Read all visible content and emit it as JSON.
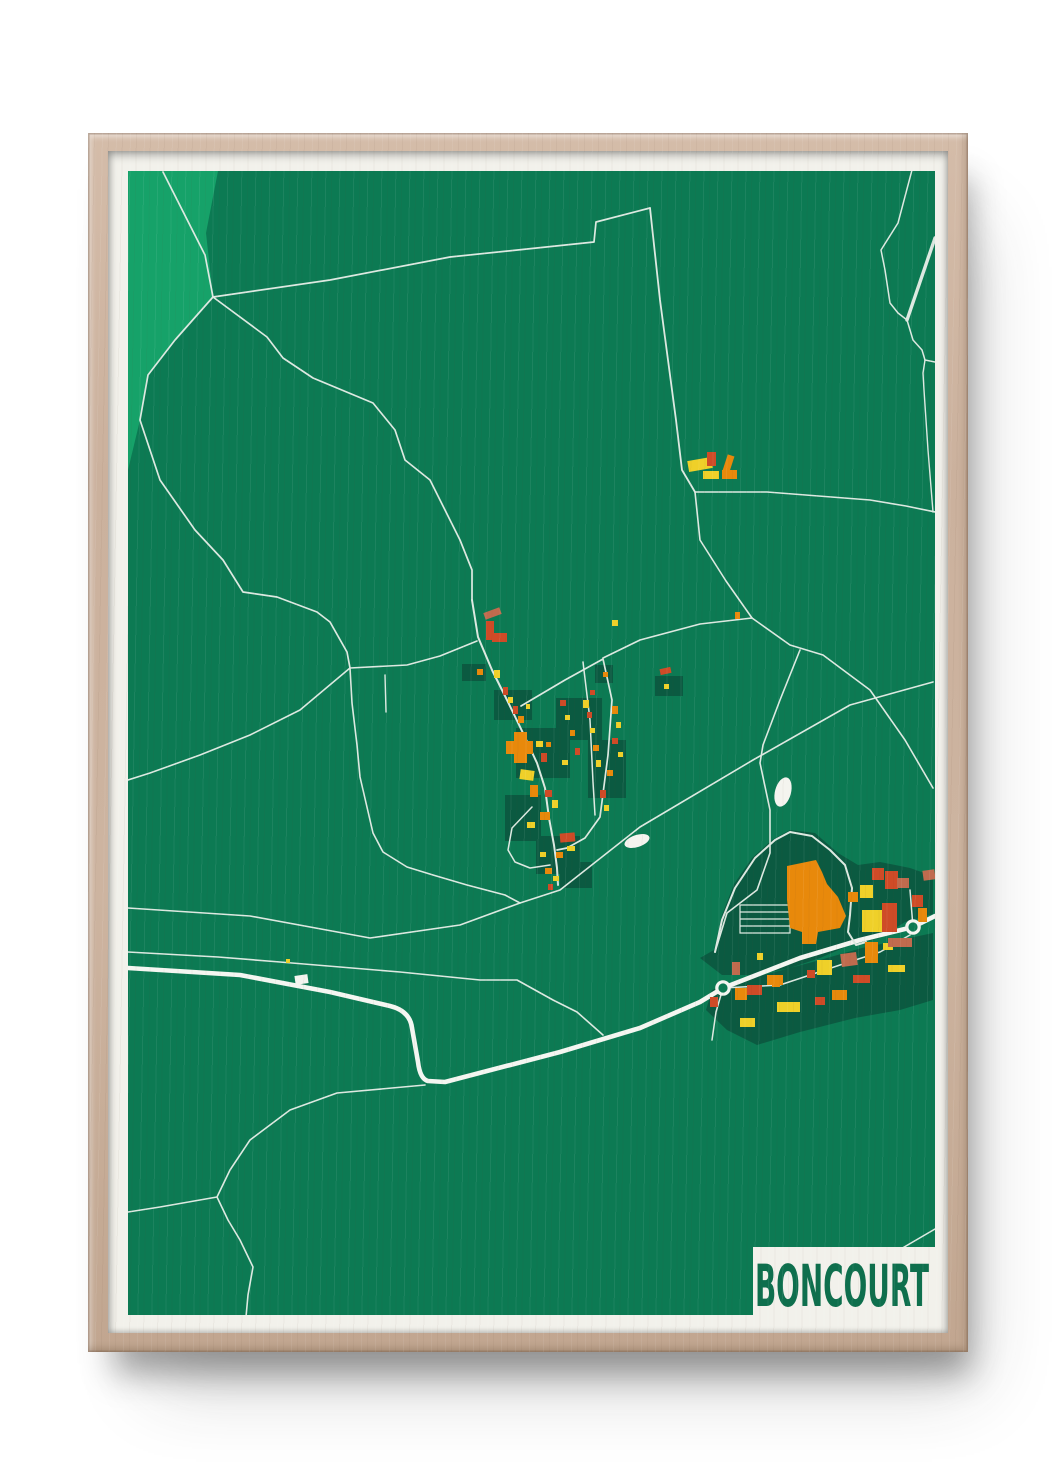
{
  "poster": {
    "title": "BONCOURT",
    "title_color": "#0e6f4d"
  },
  "theme": {
    "page_bg": "#ffffff",
    "wood": "#cbb19d",
    "paper": "#f2f1eb"
  },
  "map": {
    "width": 807,
    "height": 1144,
    "colors": {
      "base": "#0c7a53",
      "forest": "#16a269",
      "plot": "#0b5a41",
      "road": "#dde9e1",
      "road_major": "#f4f6f1",
      "white": "#f4f4ef",
      "orange": "#e8890b",
      "red": "#cf4b27",
      "salmon": "#c06b4e",
      "yellow": "#efd029"
    },
    "forest_polygon": "0,0 90,0 78,62 85,126 47,169 20,204 12,249 0,299",
    "zones": [
      "572,787 586,779 594,744 606,713 624,687 644,669 662,659 687,662 710,682 730,694 752,691 782,697 805,705 805,743 777,751 752,767 722,774 692,787 662,797 627,804 594,804",
      "578,839 584,819 607,811 647,801 692,789 734,777 772,769 805,762 805,829 772,839 727,847 672,861 629,874 599,859"
    ],
    "plots": [
      [
        334,
        493,
        24,
        17
      ],
      [
        467,
        494,
        18,
        18
      ],
      [
        527,
        505,
        28,
        20
      ],
      [
        366,
        519,
        38,
        30
      ],
      [
        388,
        557,
        54,
        50
      ],
      [
        428,
        527,
        46,
        42
      ],
      [
        460,
        569,
        38,
        58
      ],
      [
        377,
        624,
        36,
        46
      ],
      [
        408,
        665,
        44,
        38
      ],
      [
        432,
        691,
        32,
        26
      ]
    ],
    "roads": [
      {
        "name": "nw-boundary",
        "d": "M35 1 L77 84 L85 126",
        "w": 1.7
      },
      {
        "name": "west-curve",
        "d": "M85 126 L47 169 L20 204 L12 249 L32 309 L67 359 L95 389 L115 421 L149 426 L189 441 L202 451 L219 481 L222 497",
        "w": 1.7
      },
      {
        "name": "long-diagonal",
        "d": "M85 126 L202 109 L322 86 L466 71 L468 51 L522 37",
        "w": 1.7
      },
      {
        "name": "north-road",
        "d": "M522 37 L532 129 L548 249 L554 299 L567 321",
        "w": 1.8
      },
      {
        "name": "farm-east",
        "d": "M567 321 L639 321 L742 329 L778 335 L807 341",
        "w": 1.6
      },
      {
        "name": "farm-south",
        "d": "M567 321 L572 369 L598 410 L624 447",
        "w": 1.6
      },
      {
        "name": "j2-west",
        "d": "M624 447 L572 453 L512 469 L475 487",
        "w": 1.6
      },
      {
        "name": "se-road",
        "d": "M624 447 L662 474 L695 484 L742 519 L777 569 L805 617",
        "w": 1.6
      },
      {
        "name": "ind-approach",
        "d": "M672 479 L652 529 L635 574 L632 592 L642 639 L642 682 L629 719 L599 742 L587 781",
        "w": 1.6
      },
      {
        "name": "cross-diagonal",
        "d": "M805 511 L722 534 L625 589 L512 656 L432 719 L392 732 L332 754 L242 767 L122 745 L0 737",
        "w": 1.6
      },
      {
        "name": "south-field-road",
        "d": "M0 781 L90 786 L152 791 L272 801 L352 809 L389 809 L425 829 L449 841 L475 864",
        "w": 1.6
      },
      {
        "name": "village-north-approach",
        "d": "M85 126 L139 166 L155 187 L185 207 L245 232 L267 259 L277 289 L302 309 L317 339 L332 369 L344 399 L344 429",
        "w": 1.7
      },
      {
        "name": "main-street",
        "d": "M344 429 L350 466 L364 499 L379 529 L395 562 L409 592 L417 617 L421 647 L426 674 L429 697 L430 714",
        "w": 2
      },
      {
        "name": "west-branch",
        "d": "M349 470 L312 485 L279 494 L222 497 L172 539 L122 564 L72 584 L22 602 L0 609",
        "w": 1.6
      },
      {
        "name": "sw-curve",
        "d": "M222 497 L224 532 L229 574 L232 606 L245 662 L255 681 L279 696 L305 704 L339 714 L377 724 L392 732",
        "w": 1.6
      },
      {
        "name": "field-stub",
        "d": "M257 504 L258 541",
        "w": 1.4
      },
      {
        "name": "east-loop",
        "d": "M393 535 L437 509 L475 488 L484 529 L480 584 L472 646 L457 667 L439 677 L429 679",
        "w": 1.7
      },
      {
        "name": "inner-street",
        "d": "M455 491 L462 549 L465 611 L467 644",
        "w": 1.5
      },
      {
        "name": "south-loop",
        "d": "M404 636 L384 657 L380 679 L387 691 L402 697 L422 694",
        "w": 1.5
      },
      {
        "name": "sw-lane",
        "d": "M297 914 L209 922 L162 939 L122 969 L102 999 L89 1026",
        "w": 1.6
      },
      {
        "name": "sw-lane-west",
        "d": "M89 1026 L32 1036 L0 1041",
        "w": 1.6
      },
      {
        "name": "sw-lane-south",
        "d": "M89 1026 L100 1049 L112 1069 L125 1096 L120 1124 L118 1146",
        "w": 1.6
      },
      {
        "name": "ne-edge-road",
        "d": "M784 -1 L770 52 L753 79 L757 99 L762 132 L770 142 L779 149",
        "w": 1.5
      },
      {
        "name": "ne-wide-road",
        "d": "M807 67 L779 149",
        "w": 3.4
      },
      {
        "name": "ne-link",
        "d": "M779 149 L785 169 L794 179 L797 189 L807 191",
        "w": 1.5
      },
      {
        "name": "east-edge-road",
        "d": "M797 189 L795 202 L796 219 L800 279 L805 341",
        "w": 1.4
      },
      {
        "name": "highway",
        "d": "M0 797 L112 804 L202 821 L262 835 Q282 840 284 857 L290 891 Q292 908 300 910 L317 911 L432 881 L512 857 L572 831 L595 817 L672 787 L732 769 L785 756 L807 745",
        "w": 4.6,
        "major": true
      },
      {
        "name": "service-road",
        "d": "M595 817 L652 814 L712 794 L752 781 L782 764",
        "w": 1.5
      },
      {
        "name": "rb1-stub",
        "d": "M595 817 L588 841 L584 869",
        "w": 1.5
      },
      {
        "name": "rb2-stub",
        "d": "M785 756 L782 719",
        "w": 1.5
      },
      {
        "name": "factory-loop",
        "d": "M587 781 L594 749 L607 717 L627 687 L647 669 L662 661 L684 665 L702 679 L717 694 L724 717 L722 744 L720 761 L728 774 L738 771",
        "w": 2
      },
      {
        "name": "corner-road",
        "d": "M735 1100 L807 1058",
        "w": 1.5
      }
    ],
    "parking": {
      "d": "M612 734 L662 734 L662 762 L612 762 Z M612 741 L662 741 M612 748 L662 748 M612 755 L662 755",
      "w": 1.2
    },
    "factory_polygon": "659,695 688,689 694,701 699,713 710,726 718,745 712,757 690,761 688,773 674,773 674,761 662,757 659,729",
    "buildings": [
      [
        560,
        288,
        24,
        11,
        "yellow",
        -10
      ],
      [
        579,
        281,
        9,
        14,
        "red",
        0
      ],
      [
        597,
        284,
        7,
        17,
        "orange",
        18
      ],
      [
        594,
        299,
        15,
        9,
        "orange",
        0
      ],
      [
        575,
        300,
        16,
        8,
        "yellow",
        0
      ],
      [
        607,
        441,
        5,
        7,
        "orange",
        0
      ],
      [
        356,
        439,
        17,
        7,
        "salmon",
        -20
      ],
      [
        358,
        450,
        8,
        19,
        "red",
        0
      ],
      [
        364,
        462,
        15,
        9,
        "red",
        0
      ],
      [
        349,
        498,
        6,
        6,
        "orange",
        0
      ],
      [
        366,
        499,
        6,
        8,
        "yellow",
        0
      ],
      [
        532,
        497,
        11,
        6,
        "red",
        -12
      ],
      [
        536,
        513,
        5,
        5,
        "yellow",
        0
      ],
      [
        484,
        449,
        6,
        6,
        "yellow",
        0
      ],
      [
        475,
        501,
        5,
        5,
        "orange",
        0
      ],
      [
        375,
        516,
        5,
        8,
        "red",
        0
      ],
      [
        380,
        526,
        5,
        6,
        "yellow",
        0
      ],
      [
        385,
        535,
        5,
        8,
        "red",
        0
      ],
      [
        390,
        545,
        6,
        7,
        "orange",
        0
      ],
      [
        398,
        533,
        4,
        5,
        "yellow",
        0
      ],
      [
        378,
        570,
        27,
        13,
        "orange",
        0
      ],
      [
        386,
        561,
        13,
        31,
        "orange",
        0
      ],
      [
        408,
        570,
        7,
        6,
        "yellow",
        0
      ],
      [
        413,
        582,
        6,
        9,
        "red",
        0
      ],
      [
        418,
        571,
        5,
        5,
        "orange",
        0
      ],
      [
        455,
        529,
        6,
        8,
        "yellow",
        0
      ],
      [
        459,
        541,
        5,
        6,
        "red",
        0
      ],
      [
        462,
        557,
        5,
        5,
        "yellow",
        0
      ],
      [
        465,
        574,
        6,
        6,
        "orange",
        0
      ],
      [
        468,
        589,
        5,
        7,
        "yellow",
        0
      ],
      [
        462,
        519,
        5,
        5,
        "red",
        0
      ],
      [
        484,
        535,
        6,
        8,
        "orange",
        0
      ],
      [
        488,
        551,
        5,
        6,
        "yellow",
        0
      ],
      [
        484,
        567,
        6,
        6,
        "red",
        0
      ],
      [
        490,
        581,
        5,
        5,
        "yellow",
        0
      ],
      [
        479,
        599,
        6,
        6,
        "orange",
        0
      ],
      [
        472,
        619,
        6,
        8,
        "red",
        0
      ],
      [
        476,
        634,
        5,
        6,
        "yellow",
        0
      ],
      [
        432,
        529,
        6,
        6,
        "red",
        0
      ],
      [
        437,
        544,
        5,
        5,
        "yellow",
        0
      ],
      [
        442,
        559,
        5,
        6,
        "orange",
        0
      ],
      [
        447,
        577,
        5,
        7,
        "red",
        0
      ],
      [
        434,
        589,
        6,
        5,
        "yellow",
        0
      ],
      [
        392,
        599,
        14,
        10,
        "yellow",
        8
      ],
      [
        402,
        614,
        8,
        12,
        "orange",
        0
      ],
      [
        417,
        619,
        7,
        7,
        "red",
        0
      ],
      [
        424,
        629,
        6,
        8,
        "yellow",
        0
      ],
      [
        412,
        641,
        10,
        8,
        "orange",
        0
      ],
      [
        399,
        651,
        8,
        6,
        "yellow",
        0
      ],
      [
        432,
        662,
        15,
        9,
        "red",
        -5
      ],
      [
        439,
        675,
        8,
        5,
        "yellow",
        0
      ],
      [
        428,
        681,
        7,
        6,
        "orange",
        0
      ],
      [
        412,
        681,
        6,
        5,
        "yellow",
        0
      ],
      [
        417,
        697,
        7,
        6,
        "orange",
        0
      ],
      [
        425,
        705,
        6,
        5,
        "yellow",
        0
      ],
      [
        420,
        713,
        5,
        6,
        "red",
        0
      ],
      [
        167,
        804,
        13,
        9,
        "white",
        -8
      ],
      [
        158,
        788,
        4,
        4,
        "yellow",
        0
      ],
      [
        734,
        739,
        23,
        22,
        "yellow",
        0
      ],
      [
        757,
        700,
        13,
        18,
        "red",
        0
      ],
      [
        754,
        732,
        15,
        29,
        "red",
        0
      ],
      [
        769,
        707,
        12,
        10,
        "salmon",
        0
      ],
      [
        744,
        697,
        12,
        12,
        "red",
        0
      ],
      [
        795,
        699,
        12,
        10,
        "salmon",
        -8
      ],
      [
        720,
        721,
        10,
        10,
        "orange",
        0
      ],
      [
        732,
        714,
        13,
        13,
        "yellow",
        0
      ],
      [
        784,
        724,
        11,
        12,
        "red",
        0
      ],
      [
        790,
        737,
        9,
        14,
        "orange",
        0
      ],
      [
        629,
        782,
        6,
        7,
        "yellow",
        0
      ],
      [
        604,
        791,
        8,
        13,
        "salmon",
        0
      ],
      [
        582,
        826,
        8,
        10,
        "red",
        0
      ],
      [
        639,
        804,
        16,
        10,
        "orange",
        0
      ],
      [
        689,
        789,
        15,
        15,
        "yellow",
        0
      ],
      [
        679,
        799,
        8,
        8,
        "red",
        0
      ],
      [
        713,
        782,
        16,
        13,
        "salmon",
        -8
      ],
      [
        737,
        771,
        13,
        21,
        "orange",
        0
      ],
      [
        755,
        772,
        10,
        7,
        "yellow",
        0
      ],
      [
        760,
        767,
        24,
        9,
        "salmon",
        0
      ],
      [
        760,
        794,
        17,
        7,
        "yellow",
        0
      ],
      [
        725,
        804,
        17,
        8,
        "red",
        0
      ],
      [
        607,
        817,
        12,
        12,
        "orange",
        0
      ],
      [
        619,
        814,
        15,
        10,
        "red",
        0
      ],
      [
        644,
        809,
        8,
        7,
        "orange",
        0
      ],
      [
        649,
        831,
        23,
        10,
        "yellow",
        0
      ],
      [
        704,
        819,
        15,
        10,
        "orange",
        0
      ],
      [
        687,
        826,
        10,
        8,
        "red",
        0
      ],
      [
        612,
        847,
        15,
        9,
        "yellow",
        0
      ]
    ],
    "ponds": [
      {
        "cx": 509,
        "cy": 670,
        "rx": 13,
        "ry": 6,
        "rot": -18
      },
      {
        "cx": 655,
        "cy": 621,
        "rx": 8,
        "ry": 15,
        "rot": 15
      }
    ],
    "roundabouts": [
      {
        "cx": 595,
        "cy": 817
      },
      {
        "cx": 785,
        "cy": 756
      }
    ],
    "title_block": {
      "x": 625,
      "y": 1076,
      "w": 182,
      "h": 68
    }
  }
}
